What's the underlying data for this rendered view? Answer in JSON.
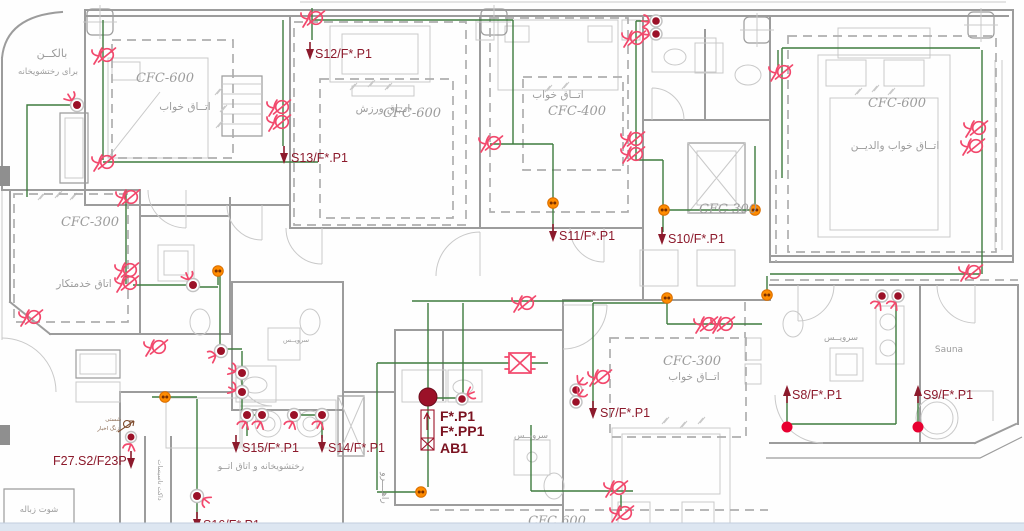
{
  "colors": {
    "wire": "#3E7C3E",
    "symbol_pink": "#F2486C",
    "dark_red": "#9B1128",
    "label_red": "#8C1A2C",
    "bold_label": "#7A1220",
    "orange": "#FF8C00",
    "endpoint_red": "#E80030",
    "wall": "#9C9C9C",
    "wall_light": "#C9C9C9",
    "dashed": "#AEAEAE",
    "room_text": "#9C9C9C",
    "band": "#DDE6F1"
  },
  "riser_labels": {
    "s12": "S12/F*.P1",
    "s13": "S13/F*.P1",
    "s11": "S11/F*.P1",
    "s10": "S10/F*.P1",
    "s7": "S7/F*.P1",
    "s8": "S8/F*.P1",
    "s9": "S9/F*.P1",
    "s15": "S15/F*.P1",
    "s14": "S14/F*.P1",
    "s16": "S16/F*.P1",
    "f27": "F27.S2/F23P"
  },
  "panel": {
    "line1": "F*.P1",
    "line2": "F*.PP1",
    "line3": "AB1"
  },
  "rooms": {
    "bedroom1_code": "CFC-600",
    "bedroom1_name": "اتــاق خواب",
    "gym_code": "CFC-600",
    "gym_name": "اتــاق ورزش",
    "bedroom2_code": "CFC-400",
    "bedroom2_name": "اتــاق خواب",
    "master_code": "CFC-600",
    "master_name": "اتــاق خواب والديــن",
    "maid_code": "CFC-300",
    "maid_name": "اتاق خدمتكار",
    "hall_code": "CFC-300",
    "bedroom3_code": "CFC-300",
    "bedroom3_name": "اتــاق خواب",
    "lower_code": "CFC 600"
  },
  "areas": {
    "balcony": "بالكــن",
    "balcony_sub": "براى رختشويخانه",
    "wc1": "سرويــس",
    "wc2": "سرويــس",
    "wc3": "سرويــس",
    "sauna": "Sauna",
    "corridor": "راهــــرو",
    "duct": "داكت تاسيسات",
    "chute": "شوت زباله",
    "laundry": "رختشويخانه و اتاق اتــو",
    "bell_note1": "شستى",
    "bell_note2": "زنگ اخبار"
  }
}
